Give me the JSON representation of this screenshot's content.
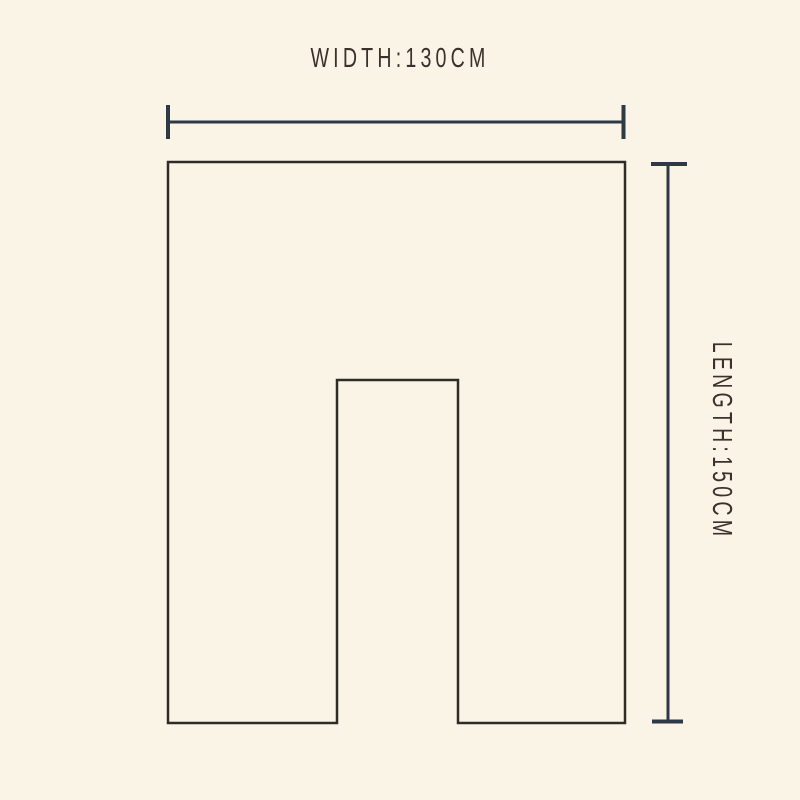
{
  "page": {
    "background_color": "#faf4e6"
  },
  "diagram": {
    "type": "product-dimension-diagram",
    "width_label": "WIDTH:130CM",
    "length_label": "LENGTH:150CM",
    "dimensions": {
      "width_value": "130CM",
      "length_value": "150CM"
    },
    "colors": {
      "outline": "#2f2c28",
      "dimension_line": "#2e3947",
      "label_text": "#3a312d"
    }
  }
}
